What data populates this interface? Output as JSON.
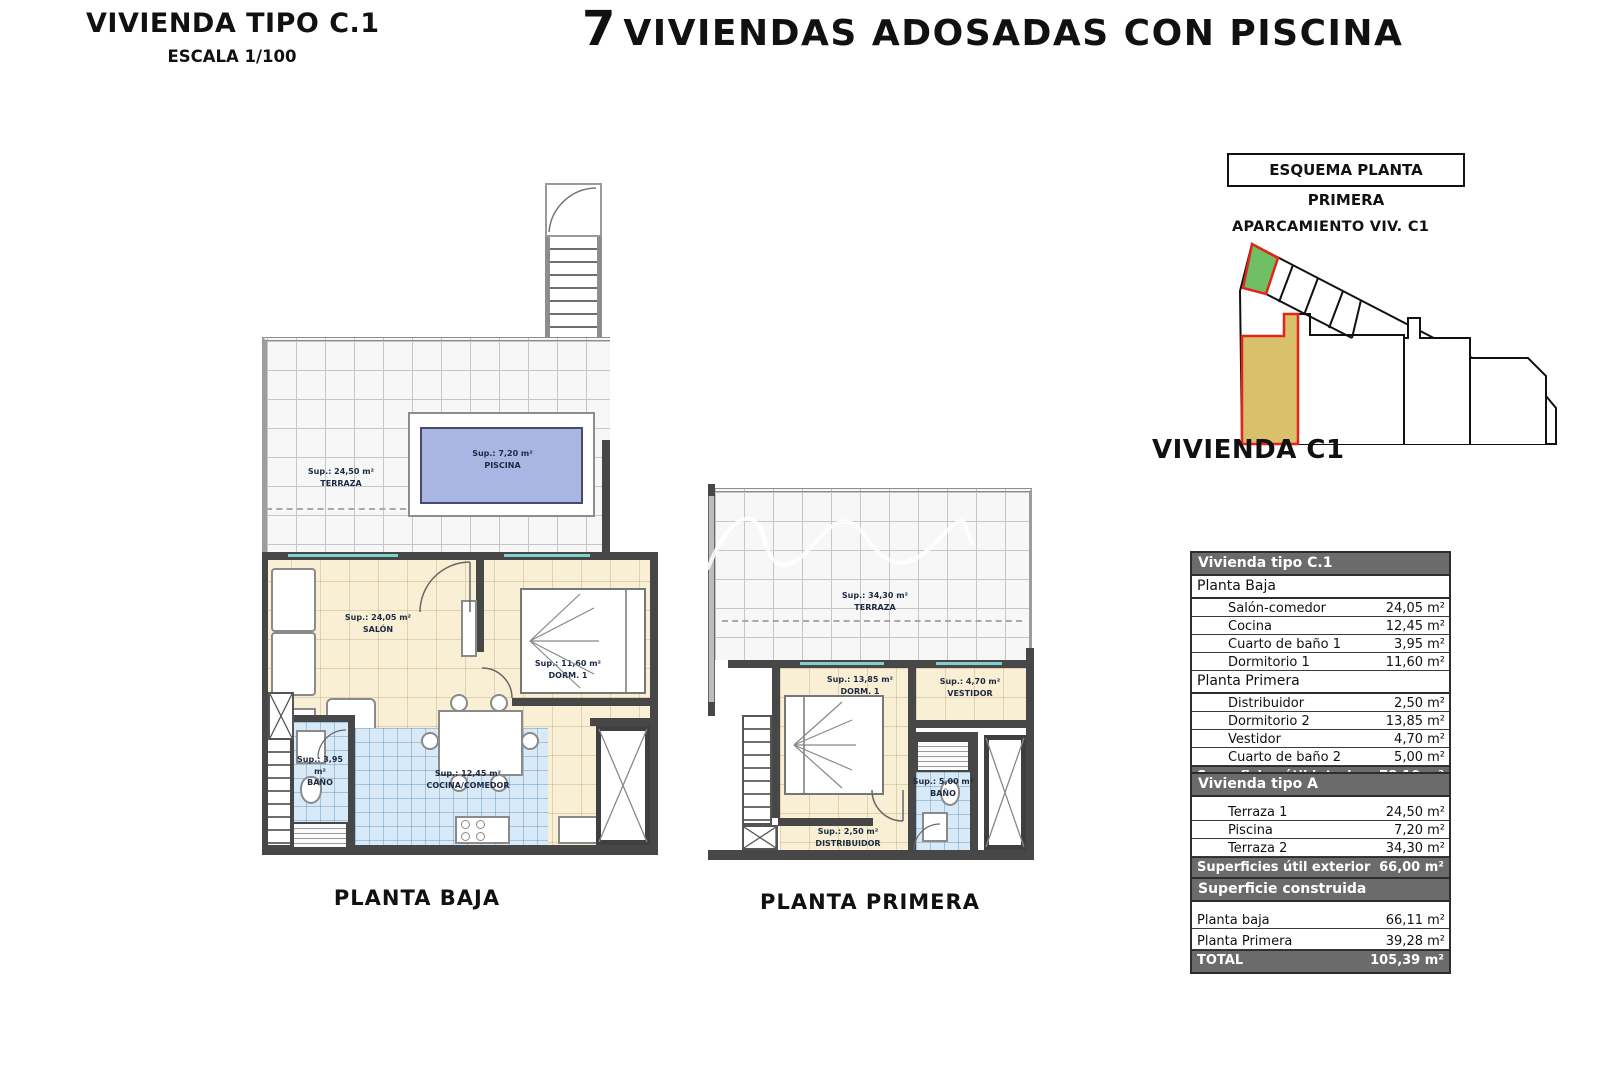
{
  "header": {
    "sheet_title": "VIVIENDA TIPO C.1",
    "sheet_scale": "ESCALA 1/100",
    "project_number": "7",
    "project_title": "VIVIENDAS ADOSADAS CON PISCINA"
  },
  "schematic": {
    "title": "ESQUEMA PLANTA PRIMERA",
    "parking_label": "APARCAMIENTO VIV. C1",
    "unit_label": "VIVIENDA C1",
    "colors": {
      "parking_green": "#6fbf63",
      "unit_tan": "#d9c06a",
      "highlight_red": "#e3241d"
    }
  },
  "plans": {
    "baja": {
      "caption": "PLANTA BAJA",
      "rooms": {
        "terraza": {
          "sup": "Sup.: 24,50 m²",
          "name": "TERRAZA"
        },
        "piscina": {
          "sup": "Sup.: 7,20 m²",
          "name": "PISCINA"
        },
        "salon": {
          "sup": "Sup.: 24,05 m²",
          "name": "SALÓN"
        },
        "dorm1": {
          "sup": "Sup.: 11,60 m²",
          "name": "DORM. 1"
        },
        "bano": {
          "sup": "Sup.: 3,95 m²",
          "name": "BAÑO"
        },
        "cocina": {
          "sup": "Sup.: 12,45 m²",
          "name": "COCINA/COMEDOR"
        }
      }
    },
    "primera": {
      "caption": "PLANTA PRIMERA",
      "rooms": {
        "terraza": {
          "sup": "Sup.: 34,30 m²",
          "name": "TERRAZA"
        },
        "dorm": {
          "sup": "Sup.: 13,85 m²",
          "name": "DORM. 1"
        },
        "vestidor": {
          "sup": "Sup.: 4,70 m²",
          "name": "VESTIDOR"
        },
        "bano": {
          "sup": "Sup.: 5,00 m²",
          "name": "BAÑO"
        },
        "distribuidor": {
          "sup": "Sup.: 2,50 m²",
          "name": "DISTRIBUIDOR"
        }
      }
    }
  },
  "tables": {
    "interior": {
      "title": "Vivienda tipo C.1",
      "section1": "Planta Baja",
      "rows1": [
        {
          "label": "Salón-comedor",
          "value": "24,05 m²"
        },
        {
          "label": "Cocina",
          "value": "12,45 m²"
        },
        {
          "label": "Cuarto de baño 1",
          "value": "3,95 m²"
        },
        {
          "label": "Dormitorio 1",
          "value": "11,60 m²"
        }
      ],
      "section2": "Planta Primera",
      "rows2": [
        {
          "label": "Distribuidor",
          "value": "2,50 m²"
        },
        {
          "label": "Dormitorio 2",
          "value": "13,85 m²"
        },
        {
          "label": "Vestidor",
          "value": "4,70 m²"
        },
        {
          "label": "Cuarto de baño 2",
          "value": "5,00 m²"
        }
      ],
      "footer": {
        "label": "Superficies útil interior",
        "value": "78,10 m²"
      }
    },
    "exterior": {
      "title": "Vivienda tipo A",
      "rows": [
        {
          "label": "Terraza 1",
          "value": "24,50 m²"
        },
        {
          "label": "Piscina",
          "value": "7,20 m²"
        },
        {
          "label": "Terraza 2",
          "value": "34,30 m²"
        }
      ],
      "footer": {
        "label": "Superficies útil exterior",
        "value": "66,00 m²"
      }
    },
    "construida": {
      "title": "Superficie construida",
      "rows": [
        {
          "label": "Planta baja",
          "value": "66,11 m²"
        },
        {
          "label": "Planta Primera",
          "value": "39,28 m²"
        }
      ],
      "footer": {
        "label": "TOTAL",
        "value": "105,39 m²"
      }
    }
  }
}
